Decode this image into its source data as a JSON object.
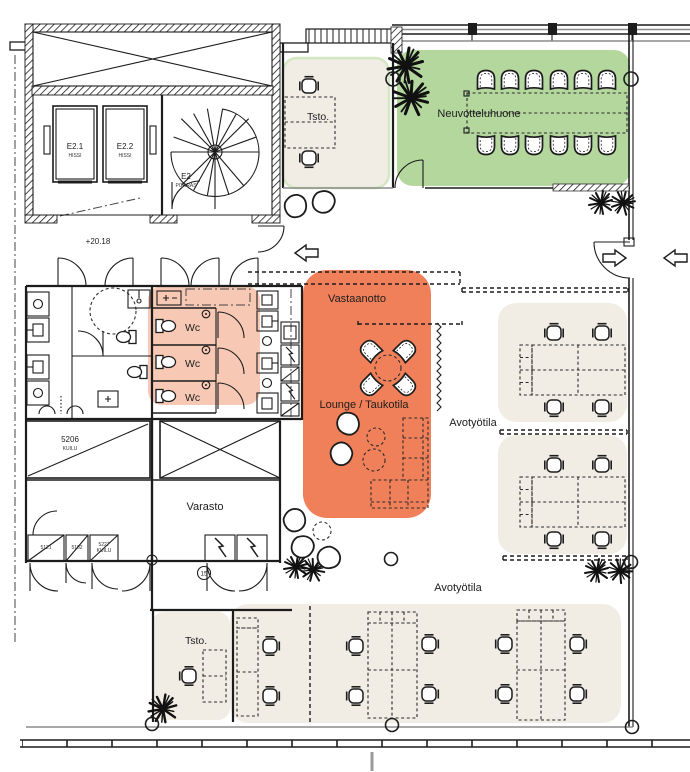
{
  "colors": {
    "meeting_room": "#b4d79e",
    "office_outline": "#d3e7c3",
    "reception": "#f08059",
    "wc": "#f7c9b4",
    "workspace": "#f1ede4",
    "ink": "#1c1c1c",
    "wall_gray": "#8b8b8b"
  },
  "rooms": {
    "meeting_room": "Neuvotteluhuone",
    "reception": "Vastaanotto",
    "lounge": "Lounge / Taukotila",
    "open_workspace_right": "Avotyötila",
    "open_workspace_bottom": "Avotyötila",
    "storage": "Varasto",
    "office_top": "Tsto.",
    "office_bottom": "Tsto.",
    "wc_1": "Wc",
    "wc_2": "Wc",
    "wc_3": "Wc"
  },
  "core": {
    "elevator_1_id": "E2.1",
    "elevator_1_type": "HISSI",
    "elevator_2_id": "E2.2",
    "elevator_2_type": "HISSI",
    "stair_id": "E2",
    "stair_type": "PORRAS"
  },
  "markers": {
    "level": "+20.18",
    "shaft_id": "5206",
    "shaft_type": "KUILU",
    "small_shaft_1": "5121",
    "small_shaft_2": "5102",
    "small_shaft_3": "5227",
    "small_shaft_3_type": "KUILU",
    "door_tag": "15"
  }
}
